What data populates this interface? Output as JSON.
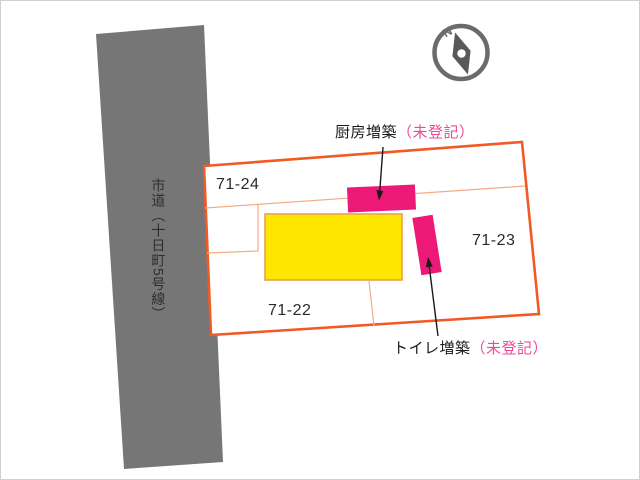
{
  "colors": {
    "background": "#ffffff",
    "road_fill": "#767676",
    "parcel_stroke": "#f15a24",
    "parcel_fill": "#ffffff",
    "inner_line": "#f5ab88",
    "building_fill": "#ffe600",
    "building_stroke": "#e8a24e",
    "extension_fill": "#ec1a76",
    "unregistered_text": "#ed4a97",
    "arrow": "#1a1a1a",
    "compass_ring": "#6b6b6b",
    "compass_needle": "#58595b",
    "compass_hub": "#ffffff"
  },
  "road": {
    "label": "市道（十日町5号線）"
  },
  "compass": {
    "north_label": "N"
  },
  "parcels": [
    {
      "label": "71-24"
    },
    {
      "label": "71-23"
    },
    {
      "label": "71-22"
    }
  ],
  "annotations": {
    "kitchen_label": "厨房増築",
    "kitchen_status": "（未登記）",
    "toilet_label": "トイレ増築",
    "toilet_status": "（未登記）"
  }
}
